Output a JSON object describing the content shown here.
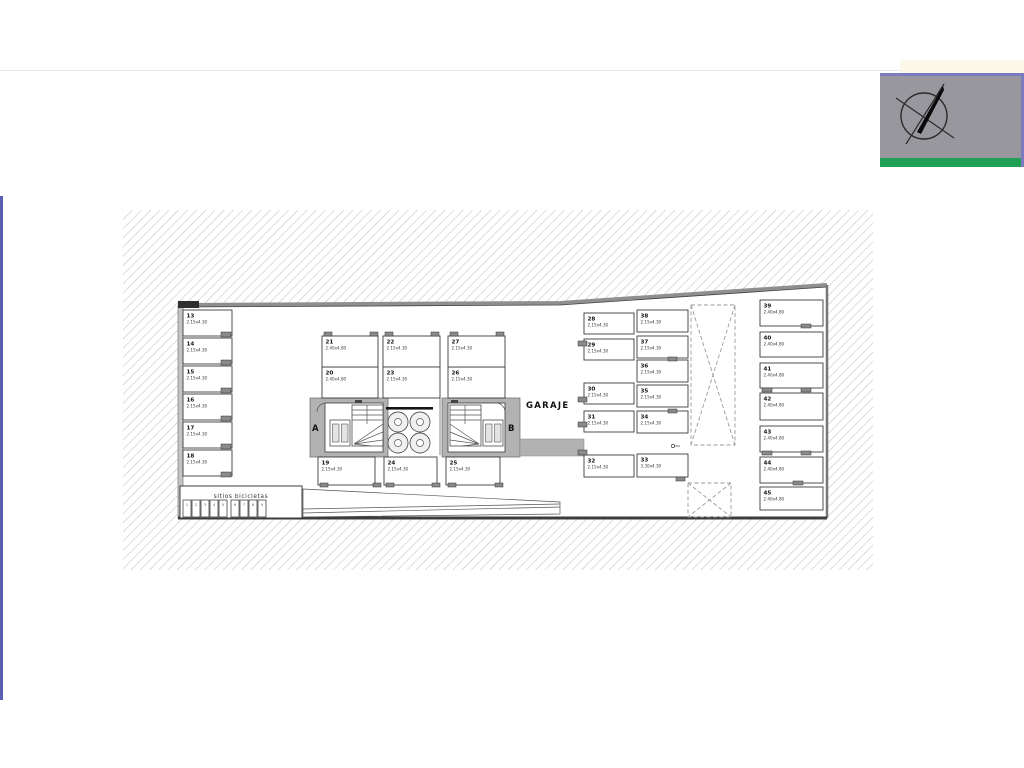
{
  "plan": {
    "garage_label": "GARAJE",
    "stair_a": "A",
    "stair_b": "B",
    "bike_label": "sitios bicicletas",
    "bike_slots": [
      "1",
      "2",
      "3",
      "4",
      "5",
      "6",
      "7",
      "8",
      "9"
    ],
    "spaces": [
      {
        "no": "13",
        "dim": "2.15x4.30"
      },
      {
        "no": "14",
        "dim": "2.15x4.30"
      },
      {
        "no": "15",
        "dim": "2.15x4.30"
      },
      {
        "no": "16",
        "dim": "2.15x4.30"
      },
      {
        "no": "17",
        "dim": "2.15x4.30"
      },
      {
        "no": "18",
        "dim": "2.15x4.30"
      },
      {
        "no": "19",
        "dim": "2.15x4.30"
      },
      {
        "no": "20",
        "dim": "2.40x4.80"
      },
      {
        "no": "21",
        "dim": "2.40x4.80"
      },
      {
        "no": "22",
        "dim": "2.15x4.30"
      },
      {
        "no": "23",
        "dim": "2.15x4.30"
      },
      {
        "no": "24",
        "dim": "2.15x4.30"
      },
      {
        "no": "25",
        "dim": "2.15x4.30"
      },
      {
        "no": "26",
        "dim": "2.15x4.30"
      },
      {
        "no": "27",
        "dim": "2.15x4.30"
      },
      {
        "no": "28",
        "dim": "2.15x4.30"
      },
      {
        "no": "29",
        "dim": "2.15x4.30"
      },
      {
        "no": "30",
        "dim": "2.15x4.30"
      },
      {
        "no": "31",
        "dim": "2.15x4.30"
      },
      {
        "no": "32",
        "dim": "2.15x4.30"
      },
      {
        "no": "33",
        "dim": "3.30x4.30"
      },
      {
        "no": "34",
        "dim": "2.15x4.30"
      },
      {
        "no": "35",
        "dim": "2.15x4.30"
      },
      {
        "no": "36",
        "dim": "2.15x4.30"
      },
      {
        "no": "37",
        "dim": "2.15x4.30"
      },
      {
        "no": "38",
        "dim": "2.15x4.30"
      },
      {
        "no": "39",
        "dim": "2.40x4.80"
      },
      {
        "no": "40",
        "dim": "2.40x4.80"
      },
      {
        "no": "41",
        "dim": "2.40x4.80"
      },
      {
        "no": "42",
        "dim": "2.40x4.80"
      },
      {
        "no": "43",
        "dim": "2.40x4.80"
      },
      {
        "no": "44",
        "dim": "2.40x4.80"
      },
      {
        "no": "45",
        "dim": "2.40x4.80"
      }
    ]
  },
  "colors": {
    "hatch_line": "#ababab",
    "wall": "#555555",
    "stair_fill": "#b2b2b2",
    "logo_bg": "#97979d",
    "logo_stripe": "#1fa055",
    "logo_border": "#7b7bc0",
    "accent_line": "#5d5db2"
  }
}
